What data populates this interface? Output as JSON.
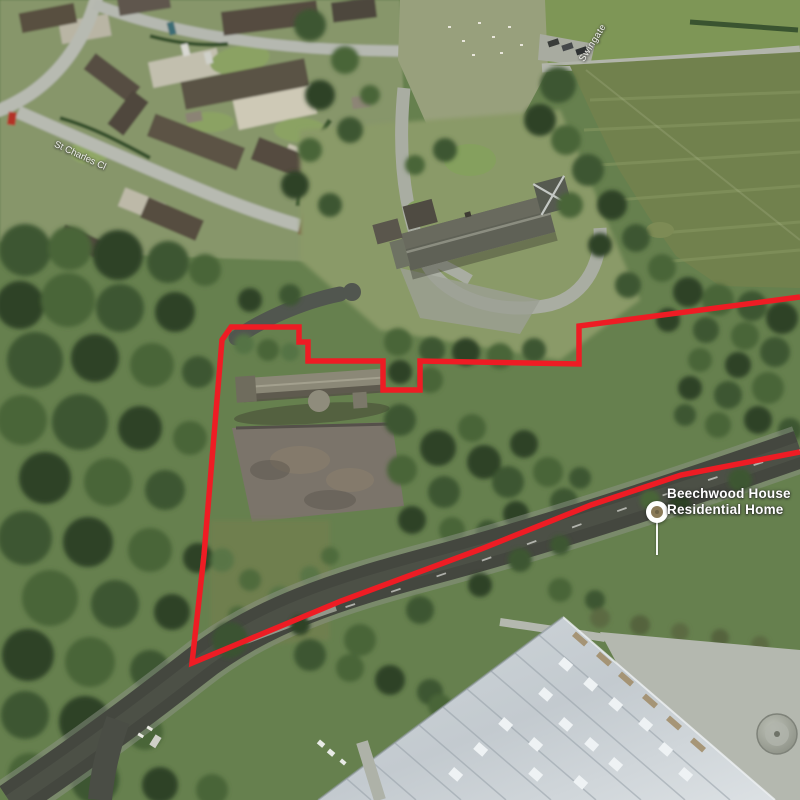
{
  "place_label": {
    "line1": "Beechwood House",
    "line2": "Residential Home"
  },
  "street_labels": {
    "left": "St Charles Cl",
    "top_right": "Swingate"
  },
  "boundary": {
    "color": "#ee1c24",
    "stroke_width": "5.5",
    "points": "800,297 579,326 579,364 420,361 420,390 383,390 383,361 308,361 308,342 299,342 299,327 231,327 222,340 204,555 192,663 341,601 481,549 591,505 681,475 800,452"
  },
  "palette": {
    "woodland_dark": "#2e4326",
    "field_green": "#71814d",
    "road_asphalt": "#44473f",
    "industrial_roof": "#d3dade",
    "marker_fill": "#8a7a58"
  }
}
